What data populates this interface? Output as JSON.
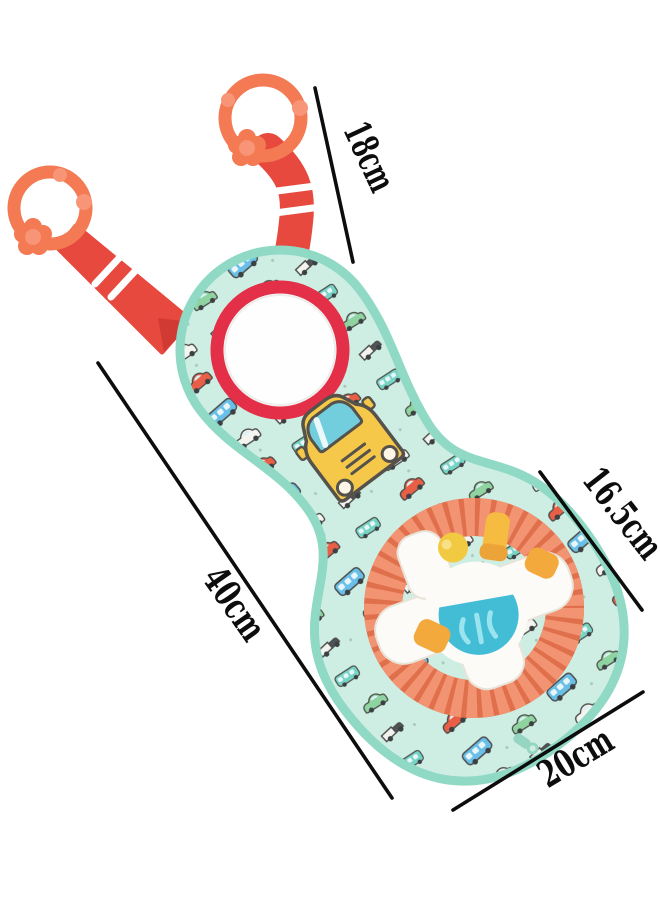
{
  "measurements": [
    {
      "name": "strap-length",
      "label": "18cm"
    },
    {
      "name": "steering-wheel-diameter",
      "label": "16.5cm"
    },
    {
      "name": "panel-length",
      "label": "40cm"
    },
    {
      "name": "panel-width",
      "label": "20cm"
    }
  ],
  "colors": {
    "background": "#ffffff",
    "strap_red": "#e8493f",
    "strap_red_dark": "#d13a33",
    "clip_orange": "#f37a52",
    "clip_orange_light": "#f89577",
    "fabric_mint": "#cfeee3",
    "binding_mint": "#8fd9c5",
    "mirror_rim_red": "#e42f49",
    "mirror_face": "#fefefe",
    "wheel_rim_coral": "#f29372",
    "wheel_rim_groove": "#e06f4b",
    "hub_white": "#fcfbf7",
    "hub_edge": "#e9e4da",
    "dome_blue": "#43bdd6",
    "dome_blue_light": "#9ae4ef",
    "button_orange": "#f4a93c",
    "ball_yellow": "#f2ca42",
    "horn_yellow": "#f5bc41",
    "horn_yellow_dark": "#eca438",
    "car_yellow": "#f5c84a",
    "car_window_teal": "#72cedd",
    "car_outline": "#55524c",
    "slider_white": "#ffffff",
    "zipper_mint": "#97d5c3",
    "dimension_line": "#0d0d0d"
  }
}
